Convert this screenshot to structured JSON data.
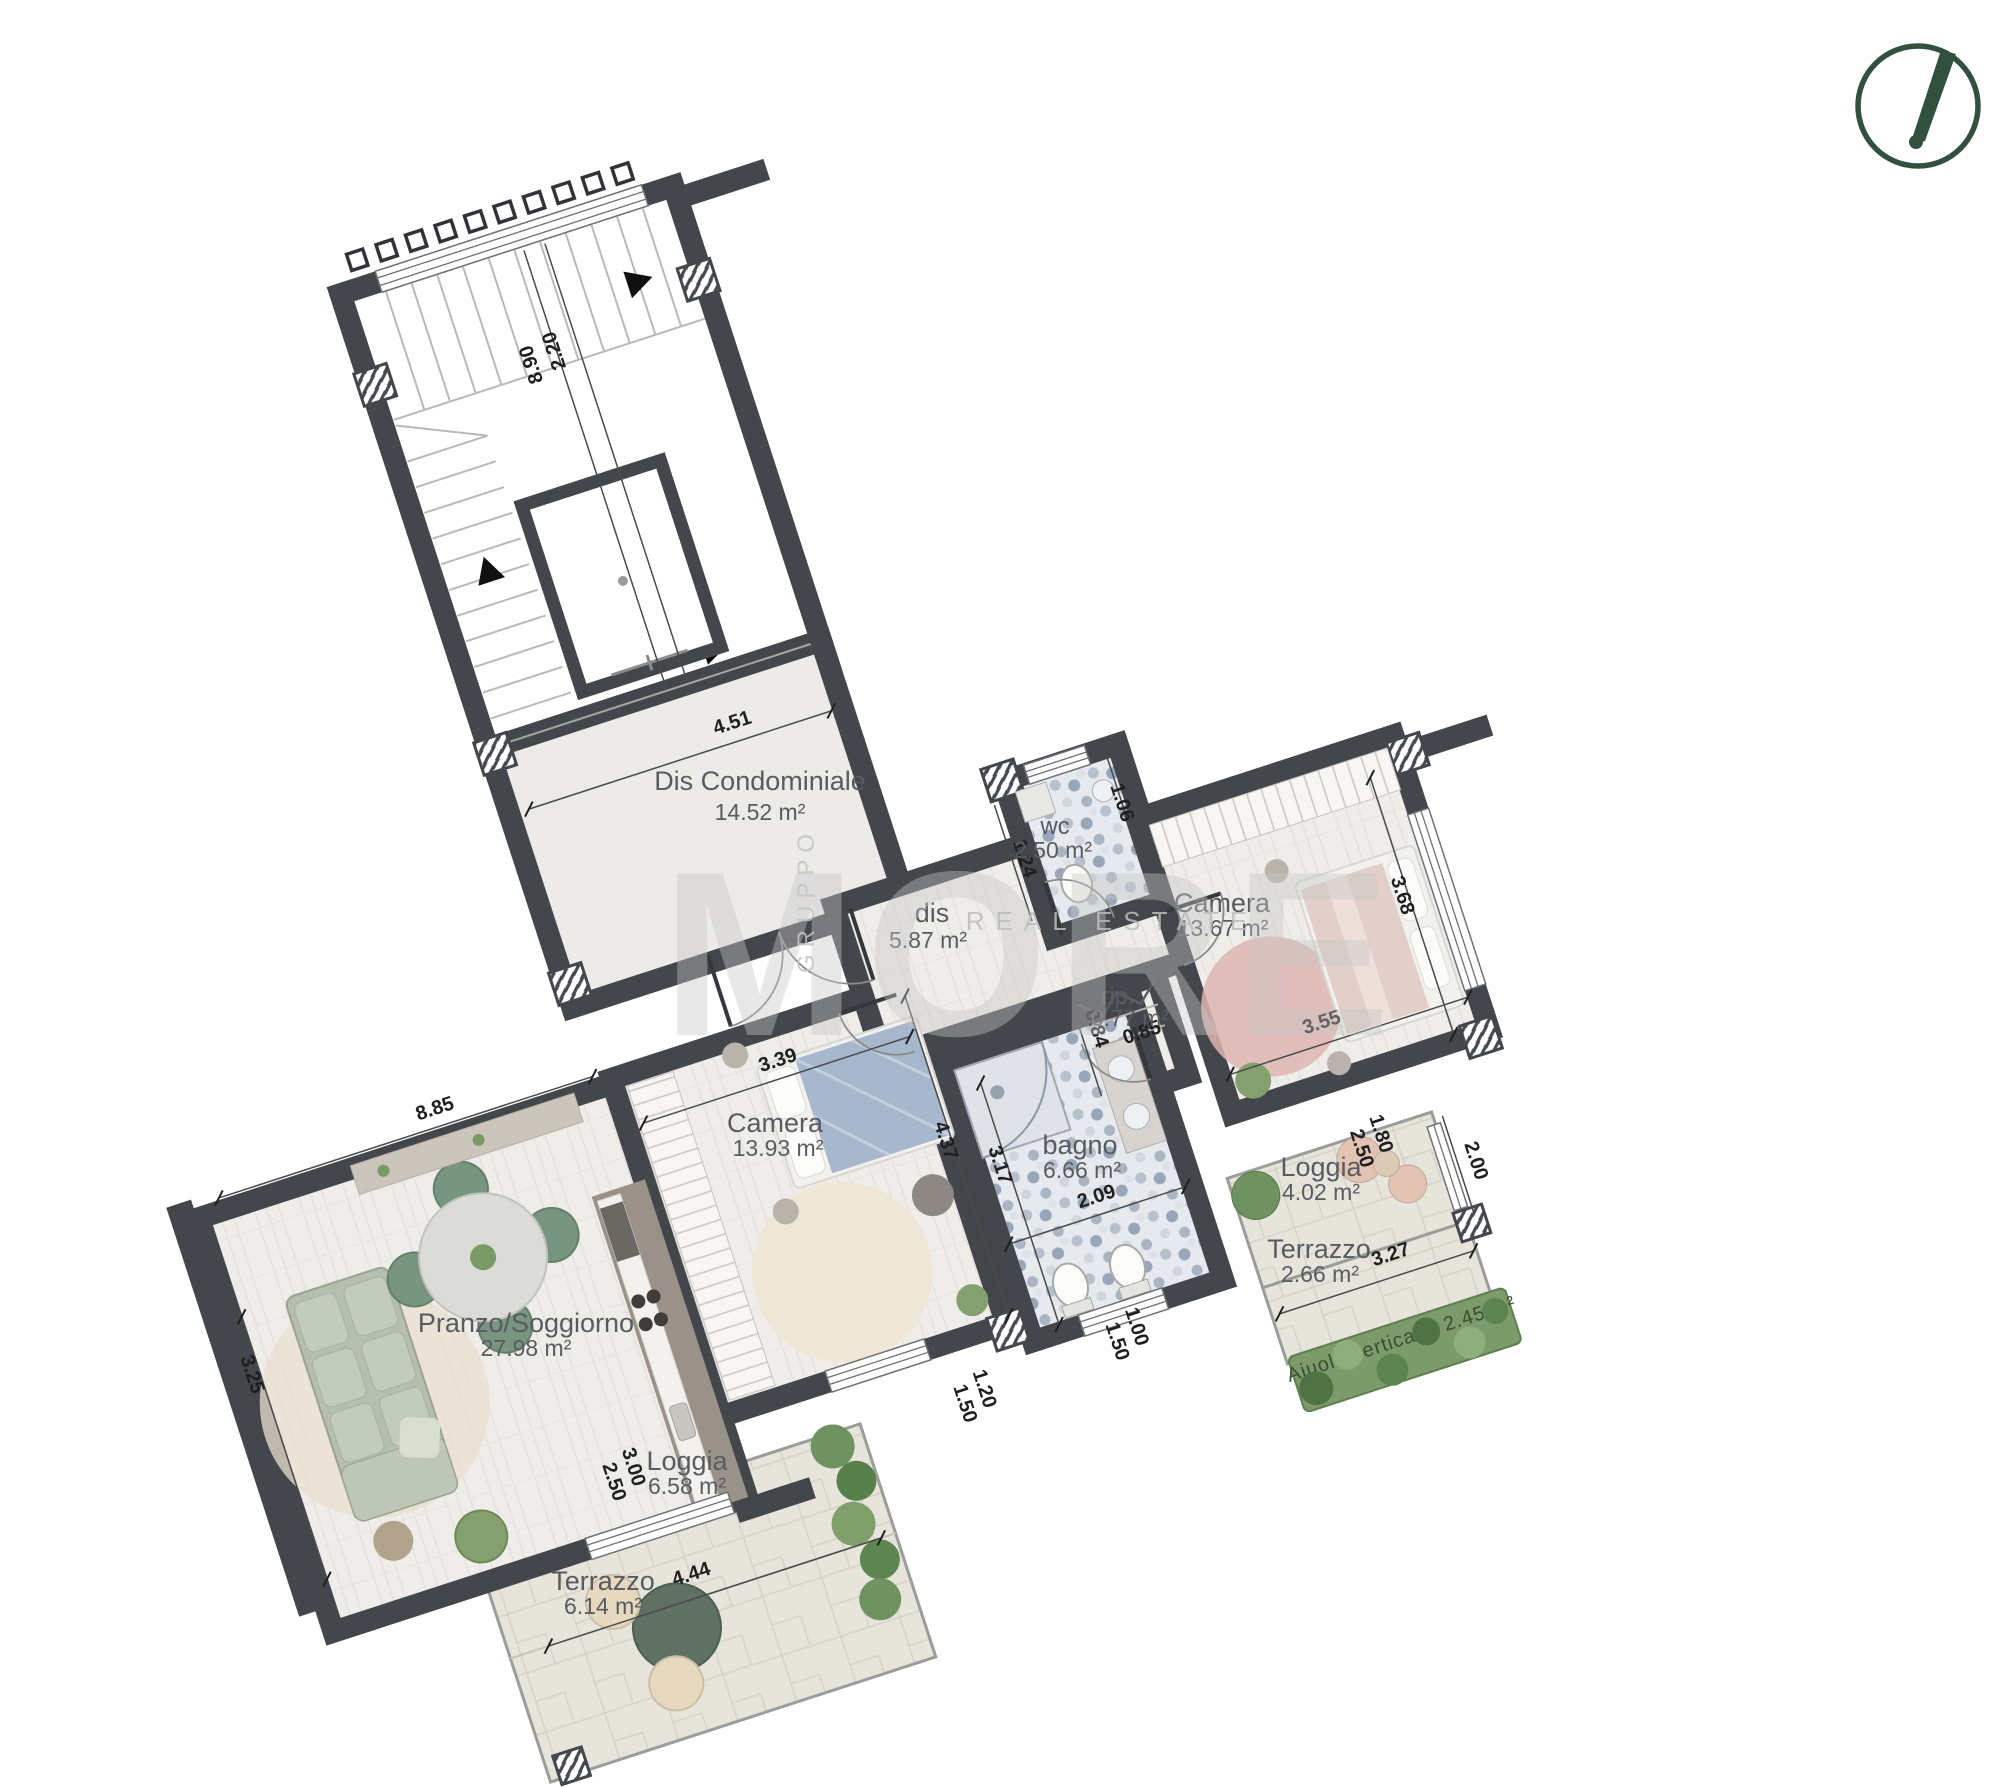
{
  "plan_title": "Apartment floor plan",
  "rooms": {
    "dis_condominiale": {
      "name": "Dis Condominiale",
      "area": "14.52 m²"
    },
    "dis": {
      "name": "dis",
      "area": "5.87 m²"
    },
    "wc": {
      "name": "wc",
      "area": "2.50 m²"
    },
    "camera_right": {
      "name": "Camera",
      "area": "13.67 m²"
    },
    "rip": {
      "name": "rip.",
      "area": "0.77 m²"
    },
    "bagno": {
      "name": "bagno",
      "area": "6.66 m²"
    },
    "camera_center": {
      "name": "Camera",
      "area": "13.93 m²"
    },
    "pranzo_soggiorno": {
      "name": "Pranzo/Soggiorno",
      "area": "27.98 m²"
    },
    "loggia_left": {
      "name": "Loggia",
      "area": "6.58 m²"
    },
    "terrazzo_left": {
      "name": "Terrazzo",
      "area": "6.14 m²"
    },
    "loggia_right": {
      "name": "Loggia",
      "area": "4.02 m²"
    },
    "terrazzo_right": {
      "name": "Terrazzo",
      "area": "2.66 m²"
    },
    "aiuola": {
      "name": "Aiuola verticale: 2.45 m²"
    }
  },
  "dimensions": {
    "stair_width": "2.20",
    "stair_length": "8.90",
    "landing_width": "4.51",
    "wc_width": "1.06",
    "wc_depth": "1.24",
    "camera_right_depth": "3.68",
    "camera_right_width": "3.55",
    "rip_width": "0.84",
    "rip_depth": "0.85",
    "camera_center_width": "3.39",
    "camera_center_depth": "4.37",
    "bagno_depth": "3.17",
    "bagno_width": "2.09",
    "living_length": "8.85",
    "living_width": "3.25",
    "loggia_left_width": "3.00",
    "loggia_left_height": "2.50",
    "window_center_width": "1.20",
    "window_center_height": "1.50",
    "window_bagno_width": "1.00",
    "window_bagno_height": "1.50",
    "terrazzo_left_width": "4.44",
    "loggia_right_width": "1.80",
    "loggia_right_height": "2.50",
    "loggia_right_depth": "2.00",
    "terrazzo_right_width": "3.27"
  },
  "watermark": {
    "group": "GRUPPO",
    "brand": "MORE",
    "tagline": "REAL ESTATE"
  },
  "colors": {
    "wall": "#43474c",
    "compass_green": "#31503e",
    "rug_pink": "#deb5b1",
    "sofa_sage": "#b6bfaf",
    "blanket_blue": "#a7b7cc",
    "plant_green": "#7b9b66"
  }
}
